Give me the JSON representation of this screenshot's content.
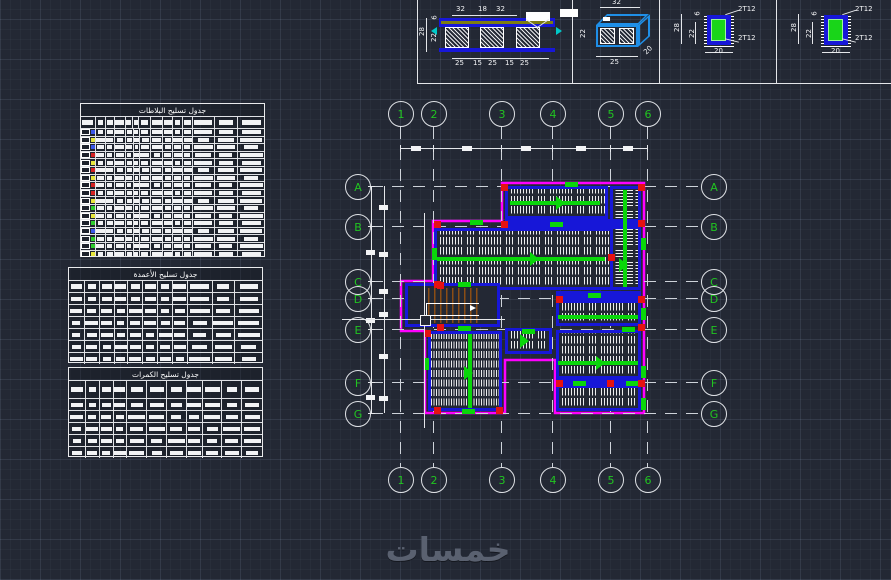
{
  "app": {
    "background": "#232834"
  },
  "watermark": {
    "text": "خمسات"
  },
  "details": {
    "slab_section": {
      "top_dims": [
        "32",
        "18",
        "32"
      ],
      "bottom_dims": [
        "25",
        "15",
        "25",
        "15",
        "25"
      ],
      "left_dims": {
        "overall": "28",
        "inner": "22",
        "top": "6"
      }
    },
    "iso_block": {
      "top": "32",
      "left": "22",
      "bottom": "25",
      "side": "20"
    },
    "beam_sections": [
      {
        "top_label": "2T12",
        "bottom_label": "2T12",
        "left_dims": {
          "overall": "28",
          "inner": "22",
          "top": "6"
        },
        "bottom_dim": "20"
      },
      {
        "top_label": "2T12",
        "bottom_label": "2T12",
        "left_dims": {
          "overall": "28",
          "inner": "22",
          "top": "6"
        },
        "bottom_dim": "20"
      }
    ]
  },
  "tables": [
    {
      "title": "جدول تسليح البلاطات",
      "rows": 17,
      "marker_colors": [
        "#3a56e8",
        "#e6e63c",
        "#3a56e8",
        "#d42222",
        "#e6e63c",
        "#d42222",
        "#e6e63c",
        "#d42222",
        "#d42222",
        "#e6e63c",
        "#2ecc2e",
        "#e6e63c",
        "#2ecc2e",
        "#3a56e8",
        "#2ecc2e",
        "#2ecc2e",
        "#e6e63c"
      ]
    },
    {
      "title": "جدول تسليح الأعمدة",
      "rows": 6,
      "marker_colors": []
    },
    {
      "title": "جدول تسليح الكمرات",
      "rows": 5,
      "marker_colors": []
    }
  ],
  "plan": {
    "col_labels": [
      "1",
      "2",
      "3",
      "4",
      "5",
      "6"
    ],
    "row_labels": [
      "A",
      "B",
      "C",
      "D",
      "E",
      "F",
      "G"
    ]
  },
  "colors": {
    "outline": "#ff00ff",
    "beam": "#1717d8",
    "rebar": "#0ad60a",
    "column": "#e51212",
    "stair": "#8a4d15"
  }
}
